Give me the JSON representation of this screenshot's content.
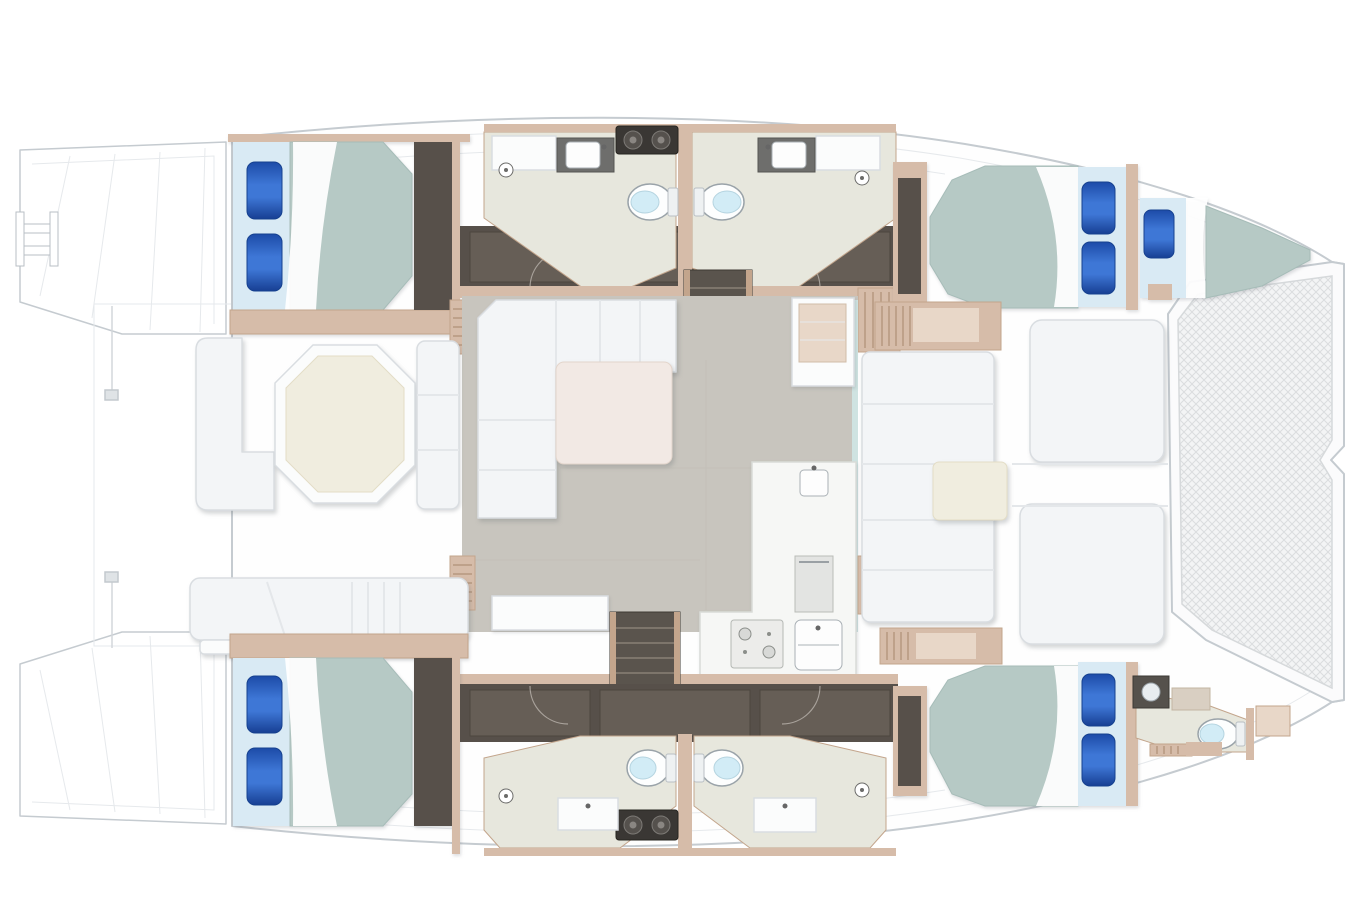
{
  "diagram": {
    "type": "yacht-floor-plan",
    "subject": "catamaran overhead accommodation and deck layout",
    "orientation": "bow to the right, stern swim platforms to the left",
    "accommodation": {
      "double_cabins": 4,
      "forepeak_berth": 1,
      "heads_compartments": 5,
      "toilets": 5,
      "blue_pillows": 9
    },
    "areas": [
      "aft swim platforms with boarding ladder",
      "aft cockpit with octagonal dining table and benches",
      "port hull: aft double cabin, two en-suite heads, forward double cabin, forepeak berth",
      "starboard hull: aft double cabin, two en-suite heads, forward double cabin with bow head",
      "saloon with L-sofa, coffee table and galley counters",
      "foredeck lounge with bench, table and two sunpads",
      "bow trampoline"
    ]
  },
  "colors": {
    "vars": {
      "outline": "#c5cbd0",
      "faint": "#e6e9ec",
      "deck": "#fefefe",
      "darkfloor": "#57504a",
      "darkpanel": "#665e56",
      "wood": "#d6bca9",
      "wooddark": "#c3a58c",
      "woodlight": "#e8d7c8",
      "mattress": "#b6c9c5",
      "mattressedge": "#a6bcb8",
      "sheet": "#d9eaf4",
      "pillowedge": "#16418f",
      "bathfloor": "#e7e7dd",
      "toiletlid": "#d2ecf6",
      "saloonfloor": "#c8c5be",
      "sofa": "#f3f5f7",
      "sofaline": "#d9dde1",
      "blush": "#f2e9e4",
      "cream": "#f0eddf",
      "glass": "#cfe3e1",
      "appliance": "#3a3734",
      "counterdark": "#6e6e6c",
      "stair": "#5a544d",
      "tread": "#7d756b",
      "meshbg": "#f3f4f5",
      "meshline": "#dbdddf"
    },
    "pillow_gradient": [
      "#1d4ba8",
      "#3e77d6",
      "#173f93"
    ]
  }
}
